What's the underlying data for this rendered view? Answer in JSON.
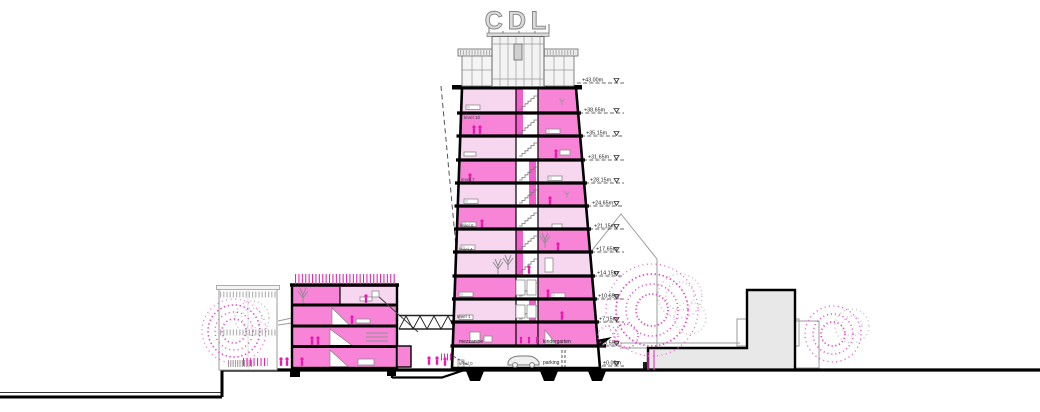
{
  "title": "architectural tower cross-section",
  "sign": {
    "text": "CDL"
  },
  "colors": {
    "bright_pink": "#f884d8",
    "light_pink": "#f7d6ef",
    "magenta": "#e818b0",
    "core_pink": "#f45fce",
    "building_gray": "#e8e8e8"
  },
  "levels": [
    {
      "label": "+43.00m"
    },
    {
      "label": "+38.65m"
    },
    {
      "label": "+35.15m"
    },
    {
      "label": "+31.65m"
    },
    {
      "label": "+28.15m"
    },
    {
      "label": "+24.65m"
    },
    {
      "label": "+21.15m"
    },
    {
      "label": "+17.65m"
    },
    {
      "label": "+14.15m"
    },
    {
      "label": "+10.65m"
    },
    {
      "label": "+7.15m"
    },
    {
      "label": "+3.55m"
    },
    {
      "label": "±0.00m"
    }
  ],
  "floors": {
    "level10": "level 10",
    "level7": "level 7",
    "level6": "level 6",
    "level4": "level 4",
    "level1": "level 1",
    "level0": "level 0",
    "mezzanine": "mezzanine",
    "kindergarten": "kindergarten",
    "parking": "parking"
  }
}
